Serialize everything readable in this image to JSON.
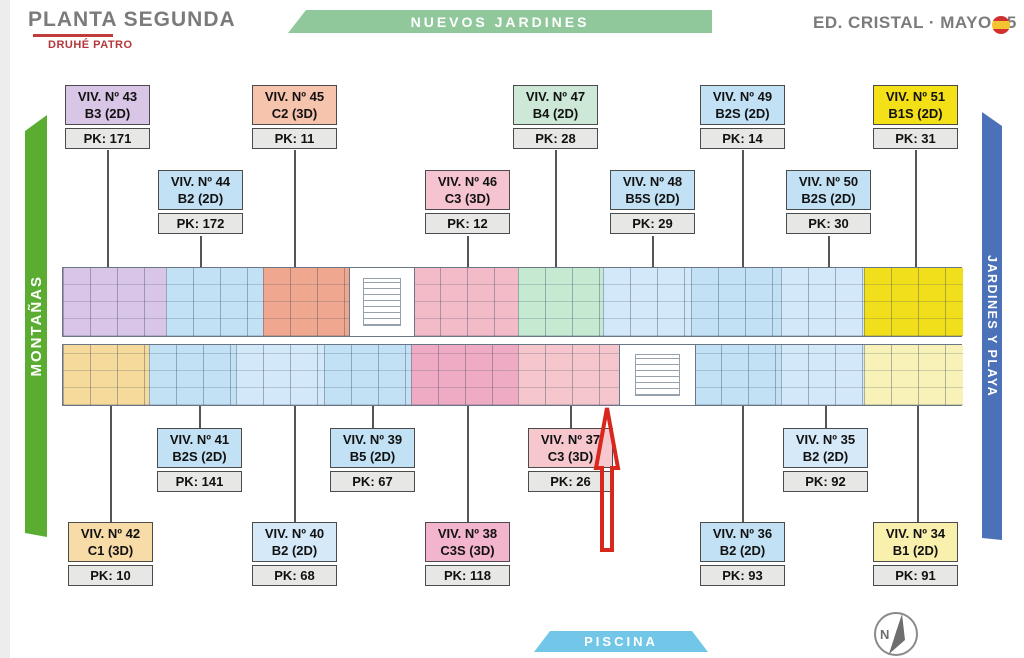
{
  "header": {
    "title": "PLANTA SEGUNDA",
    "subtitle": "DRUHÉ PATRO",
    "project": "ED. CRISTAL · MAYO 25"
  },
  "banners": {
    "top": "NUEVOS JARDINES",
    "left": "MONTAÑAS",
    "right": "JARDINES Y PLAYA",
    "bottom": "PISCINA"
  },
  "compass": {
    "label": "N"
  },
  "units": [
    {
      "line1": "VIV. Nº 43",
      "line2": "B3 (2D)",
      "pk": "PK: 171"
    },
    {
      "line1": "VIV. Nº 45",
      "line2": "C2 (3D)",
      "pk": "PK: 11"
    },
    {
      "line1": "VIV. Nº 47",
      "line2": "B4 (2D)",
      "pk": "PK: 28"
    },
    {
      "line1": "VIV. Nº 49",
      "line2": "B2S (2D)",
      "pk": "PK: 14"
    },
    {
      "line1": "VIV. Nº 51",
      "line2": "B1S (2D)",
      "pk": "PK: 31"
    },
    {
      "line1": "VIV. Nº 44",
      "line2": "B2 (2D)",
      "pk": "PK: 172"
    },
    {
      "line1": "VIV. Nº 46",
      "line2": "C3 (3D)",
      "pk": "PK: 12"
    },
    {
      "line1": "VIV. Nº 48",
      "line2": "B5S (2D)",
      "pk": "PK: 29"
    },
    {
      "line1": "VIV. Nº 50",
      "line2": "B2S (2D)",
      "pk": "PK: 30"
    },
    {
      "line1": "VIV. Nº 41",
      "line2": "B2S (2D)",
      "pk": "PK: 141"
    },
    {
      "line1": "VIV. Nº 39",
      "line2": "B5 (2D)",
      "pk": "PK: 67"
    },
    {
      "line1": "VIV. Nº 37",
      "line2": "C3 (3D)",
      "pk": "PK: 26"
    },
    {
      "line1": "VIV. Nº 35",
      "line2": "B2 (2D)",
      "pk": "PK: 92"
    },
    {
      "line1": "VIV. Nº 42",
      "line2": "C1 (3D)",
      "pk": "PK: 10"
    },
    {
      "line1": "VIV. Nº 40",
      "line2": "B2 (2D)",
      "pk": "PK: 68"
    },
    {
      "line1": "VIV. Nº 38",
      "line2": "C3S (3D)",
      "pk": "PK: 118"
    },
    {
      "line1": "VIV. Nº 36",
      "line2": "B2 (2D)",
      "pk": "PK: 93"
    },
    {
      "line1": "VIV. Nº 34",
      "line2": "B1 (2D)",
      "pk": "PK: 91"
    }
  ],
  "palette": {
    "banner_green_light": "#90C89C",
    "banner_green": "#5BAD31",
    "banner_blue": "#4B72B8",
    "banner_pool_blue": "#72C7E9",
    "title_gray": "#7B7B7B",
    "brand_red": "#B5373B",
    "arrow_red": "#D8281E",
    "unit_lavender": "#D9C5E5",
    "unit_blue": "#C3E1F5",
    "unit_blue_light": "#D5E9F8",
    "unit_salmon": "#EFA88F",
    "unit_pink": "#F3BAC8",
    "unit_pink_dark": "#F0ABC4",
    "unit_mint": "#C6E9D2",
    "unit_yellow": "#F2DF1C",
    "unit_pale_yellow": "#F8F1B8",
    "unit_tan": "#F5DA9B",
    "pk_gray": "#E7E7E5"
  }
}
